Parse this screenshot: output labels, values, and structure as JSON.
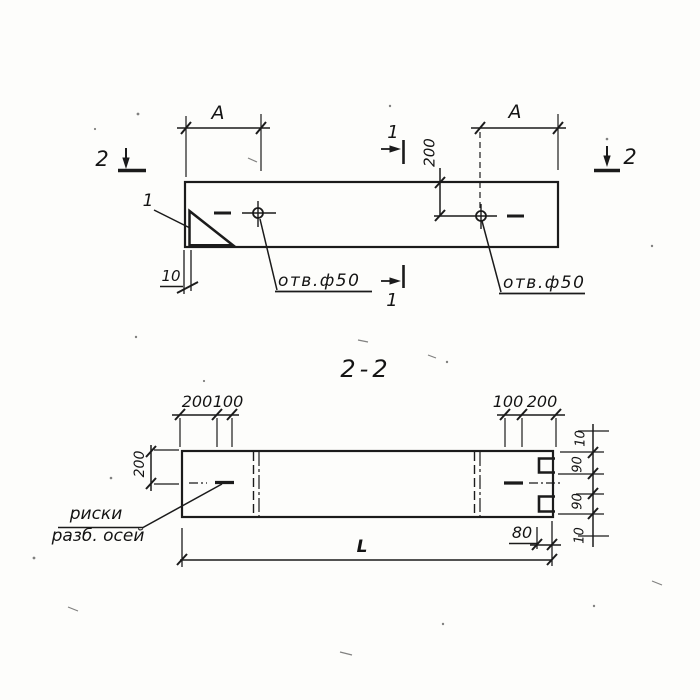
{
  "section_title": "2-2",
  "top_view": {
    "dim_a_left": "A",
    "dim_a_right": "A",
    "dim_200": "200",
    "dim_10": "10",
    "hole_left_label": "отв.ф50",
    "hole_right_label": "отв.ф50",
    "detail_mark": "1",
    "section2_left": "2",
    "section2_right": "2",
    "section1_top": "1",
    "section1_bottom": "1"
  },
  "section_view": {
    "dim_left_200": "200",
    "dim_left_100": "100",
    "dim_right_100": "100",
    "dim_right_200": "200",
    "dim_height": "200",
    "dim_r10_top": "10",
    "dim_r90_top": "90",
    "dim_r90_bottom": "90",
    "dim_r10_bottom": "10",
    "dim_80": "80",
    "dim_length": "L",
    "note_line1": "риски",
    "note_line2": "разб. осей"
  },
  "colors": {
    "ink": "#1b1b1b",
    "paper": "#fdfdfb"
  }
}
